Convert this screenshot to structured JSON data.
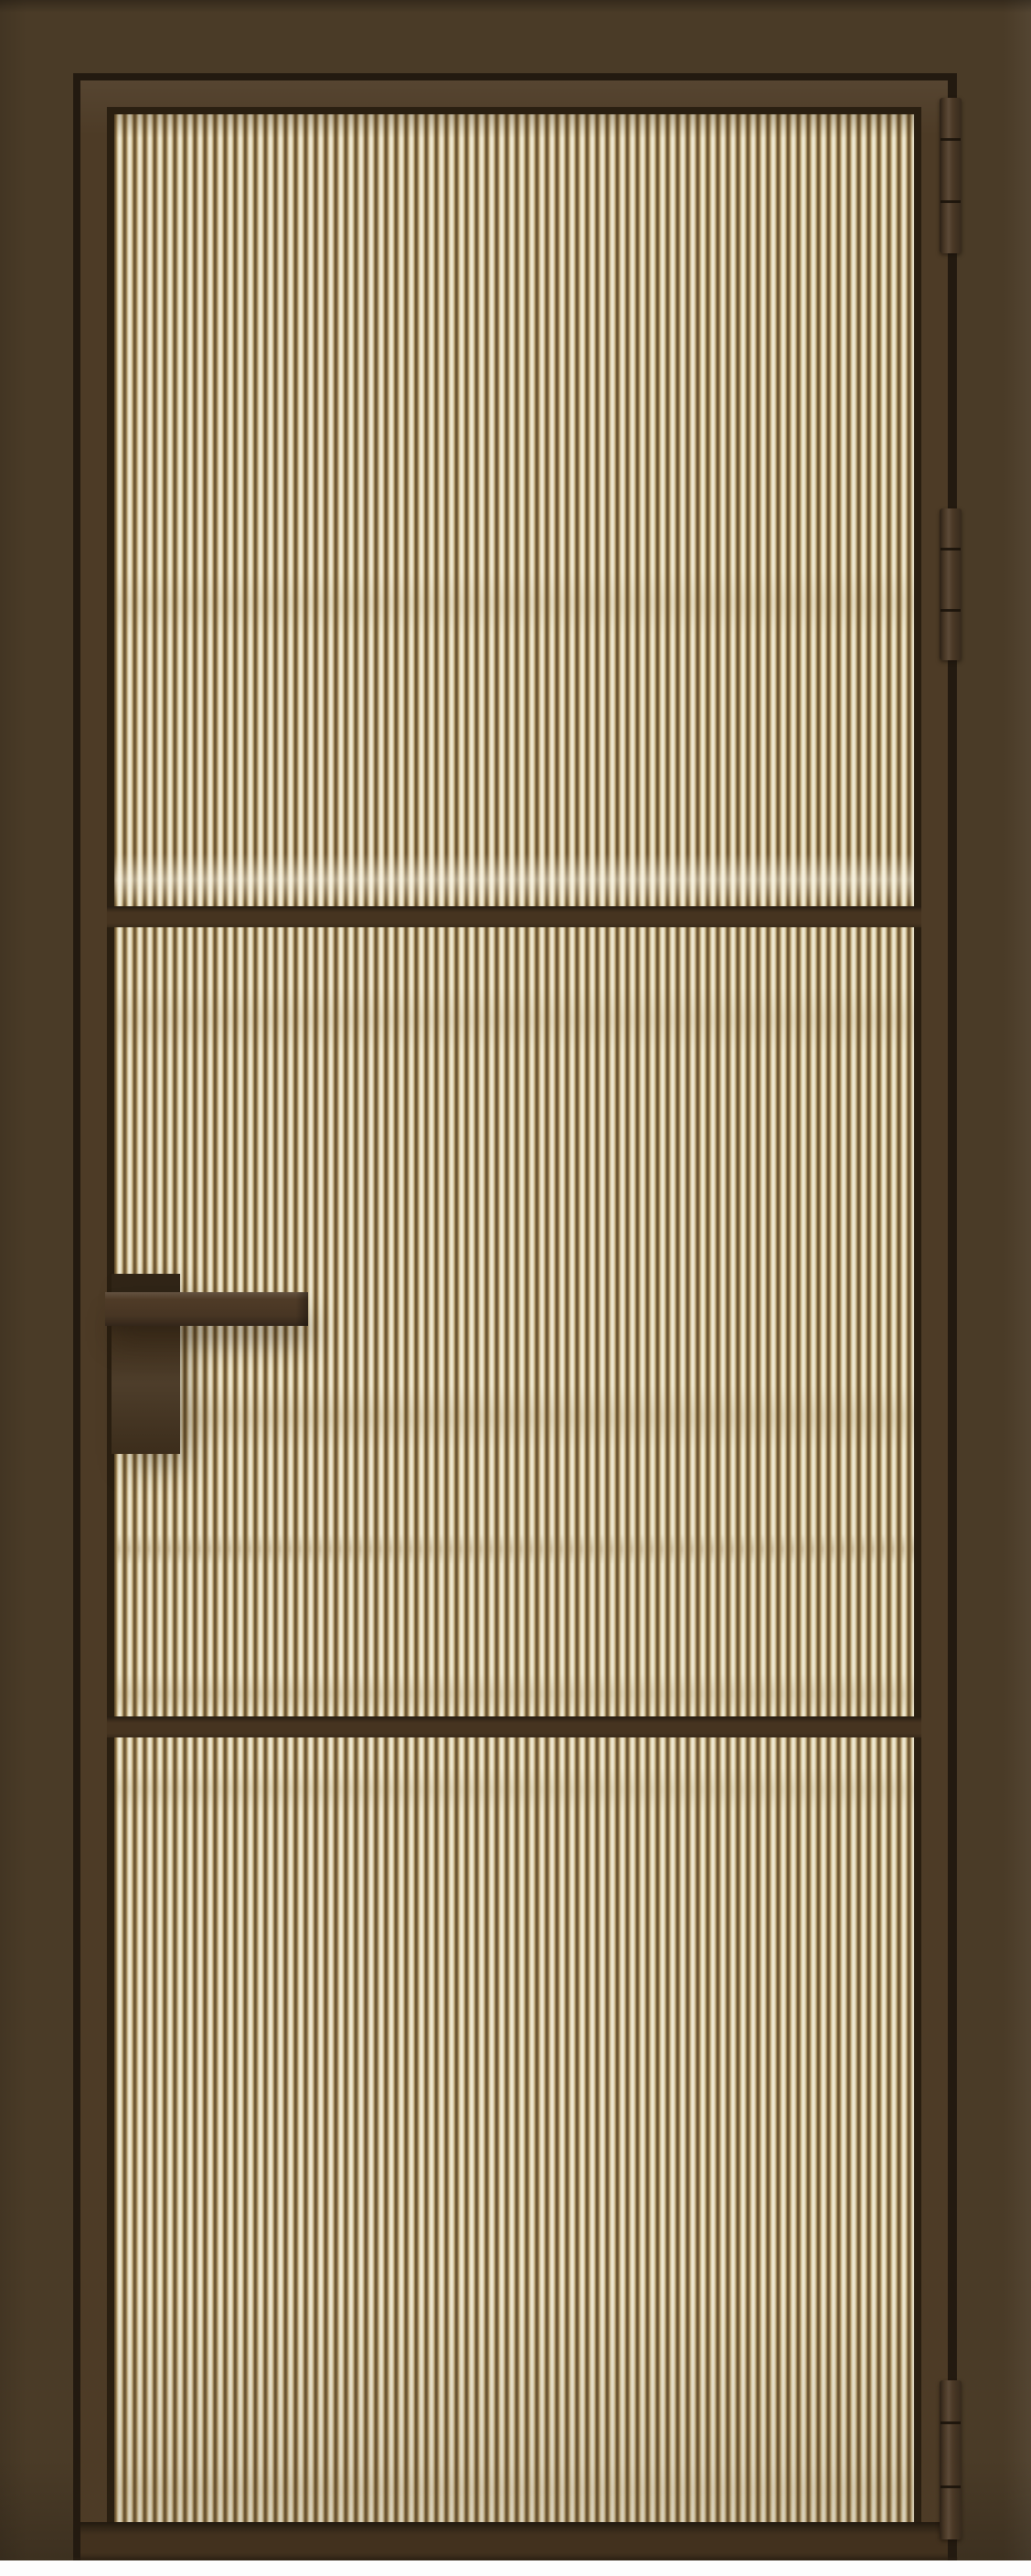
{
  "scene": {
    "type": "product-render",
    "subject": "interior-door-with-fluted-glass",
    "glass_type": "fluted-reeded-translucent",
    "glass_panel_count": 3,
    "glazing_bar_count": 2,
    "hinge_count": 3,
    "hinge_side": "right",
    "handle_type": "square-lever",
    "handle_side": "left",
    "frame_finish": "deco-bronze",
    "background": "white-floor-strip"
  },
  "palette": {
    "wall": "#4a3b27",
    "gap": "#231a10",
    "frame": "#4d3b26",
    "glazing_shadow": "#2a1f11",
    "glass_base": "#cdbe97",
    "glass_light": "#f4eedc",
    "glass_mid": "#dcd1ae",
    "glass_groove": "#a78c5d",
    "glass_dark_line": "#6b5532",
    "divider": "#463420",
    "rail": "#42311e",
    "handle": "#4f3b27",
    "handle_dark": "#44331f",
    "hinge": "#4f3c28",
    "floor": "#fdfdfd"
  }
}
